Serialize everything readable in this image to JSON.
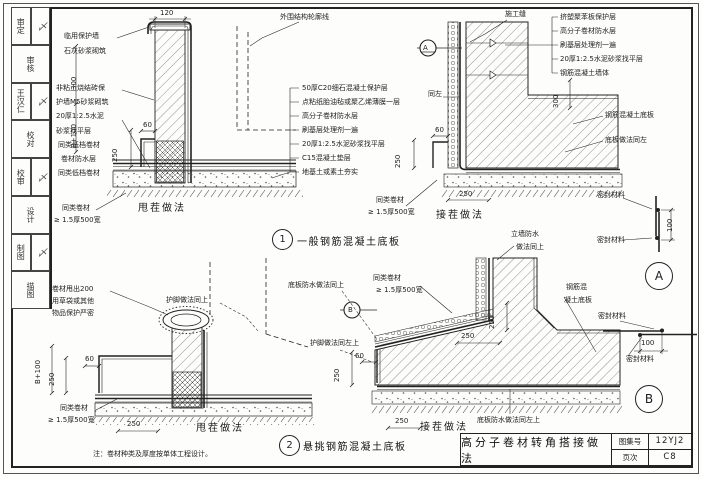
{
  "sidebar": {
    "rows": [
      [
        "审定",
        "〆"
      ],
      [
        "审核"
      ],
      [
        "王汉仁",
        "〆"
      ],
      [
        "校对"
      ],
      [
        "校审",
        "〆"
      ],
      [
        "设计"
      ],
      [
        "制图",
        "〆"
      ],
      [
        "描图"
      ]
    ]
  },
  "d1": {
    "num": "1",
    "title": "一般钢筋混凝土底板",
    "cap_left": "甩茬做法",
    "cap_right": "接茬做法",
    "outline": "外围结构轮廓线",
    "joint": "施工缝",
    "same_left": "同左",
    "wall1": "临用保护墙",
    "wall2": "石灰砂浆砌筑",
    "left_labels": [
      "非粘土烧结砖保",
      "护墙M5砂浆砌筑",
      "20厚1:2.5水泥",
      "砂浆找平层",
      "同类低档卷材",
      "卷材防水层",
      "同类低档卷材"
    ],
    "tail1": "同类卷材",
    "tail2": "≥ 1.5厚500宽",
    "layers": [
      "50厚C20细石混凝土保护层",
      "点粘纸胎油毡或聚乙烯薄膜一层",
      "高分子卷材防水层",
      "刷基层处理剂一遍",
      "20厚1:2.5水泥砂浆找平层",
      "C15混凝土垫层",
      "地基土或素土夯实"
    ],
    "right_layers": [
      "挤塑聚苯板保护层",
      "高分子卷材防水层",
      "刷基层处理剂一遍",
      "20厚1:2.5水泥砂浆找平层",
      "钢筋混凝土墙体"
    ],
    "slab": "钢筋混凝土底板",
    "slab_same": "底板做法同左",
    "tail3": "同类卷材",
    "tail4": "≥ 1.5厚500宽",
    "dims": {
      "w120": "120",
      "h300": "300",
      "b100": "B+100",
      "v250": "250",
      "h60": "60",
      "r300": "300",
      "rv250": "250",
      "rh60": "60",
      "rb250": "250"
    }
  },
  "d2": {
    "num": "2",
    "title": "悬挑钢筋混凝土底板",
    "cap_left": "甩茬做法",
    "cap_right": "接茬做法",
    "tail_note1": "卷材甩出200",
    "tail_note2": "用草袋或其他",
    "tail_note3": "物品保护严密",
    "foot_up": "护脚做法同上",
    "slab_wp_up": "底板防水做法同上",
    "wall_wp1": "立墙防水",
    "wall_wp2": "做法同上",
    "tail1": "同类卷材",
    "tail2": "≥ 1.5厚500宽",
    "tail3": "同类卷材",
    "tail4": "≥ 1.5厚500宽",
    "foot_left_up": "护脚做法同左上",
    "slab1": "钢筋混",
    "slab2": "凝土底板",
    "slab_wp_left_up": "底板防水做法同左上",
    "dims": {
      "b100": "B+100",
      "v250": "250",
      "h60": "60",
      "b250": "250",
      "rv250": "250",
      "rl250": "250",
      "rh60": "60",
      "ru250": "250",
      "rb250": "250"
    }
  },
  "dA": {
    "letter": "A",
    "seal_top": "密封材料",
    "seal_bot": "密封材料",
    "dim": "100"
  },
  "dB": {
    "letter": "B",
    "seal_top": "密封材料",
    "seal_bot": "密封材料",
    "dim": "100"
  },
  "note": "注：卷材种类及厚度按单体工程设计。",
  "tb": {
    "title": "高分子卷材转角搭接做法",
    "atlas_label": "图集号",
    "atlas_no": "12YJ2",
    "page_label": "页次",
    "page_no": "C8"
  }
}
